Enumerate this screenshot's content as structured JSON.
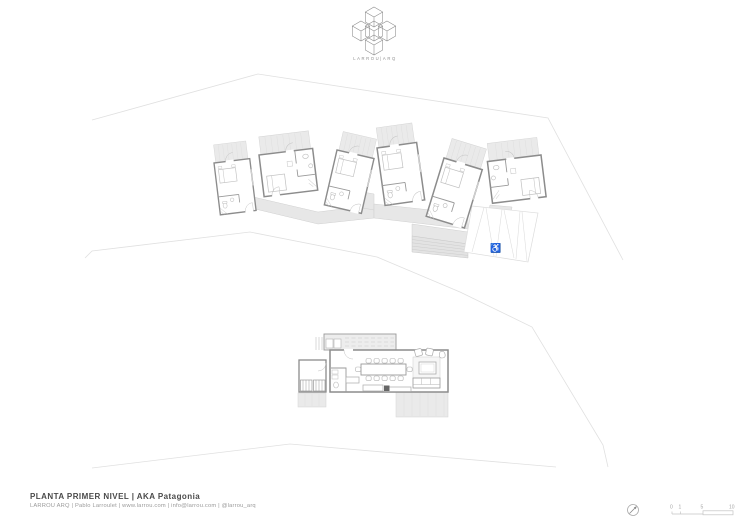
{
  "logo": {
    "wordmark": "LARROU|ARQ"
  },
  "title_block": {
    "title": "PLANTA PRIMER NIVEL | AKA Patagonia",
    "credits": "LARROU ARQ | Pablo Larroulet | www.larrou.com | info@larrou.com | @larrou_arq"
  },
  "scale_bar": {
    "labels": [
      "0",
      "1",
      "5",
      "10"
    ]
  },
  "icons": {
    "accessible_parking": "♿",
    "north_arrow": "compass-circle-with-ne-needle"
  },
  "drawing": {
    "type": "architectural-site-floor-plan",
    "elements": [
      "6 guest cabins with decks",
      "connecting boardwalk",
      "stairs",
      "accessible parking bays",
      "main lodge with dining and lounge",
      "site boundary lines"
    ]
  },
  "colors": {
    "background": "#ffffff",
    "wall": "#8c8c8c",
    "partition": "#a8a8a8",
    "furniture": "#b3b3b3",
    "deck_fill": "#eaeaea",
    "walkway_fill": "#e7e7e7",
    "site_line": "#e0e0e0",
    "text_primary": "#4a4a4a",
    "text_secondary": "#9b9b9b"
  }
}
